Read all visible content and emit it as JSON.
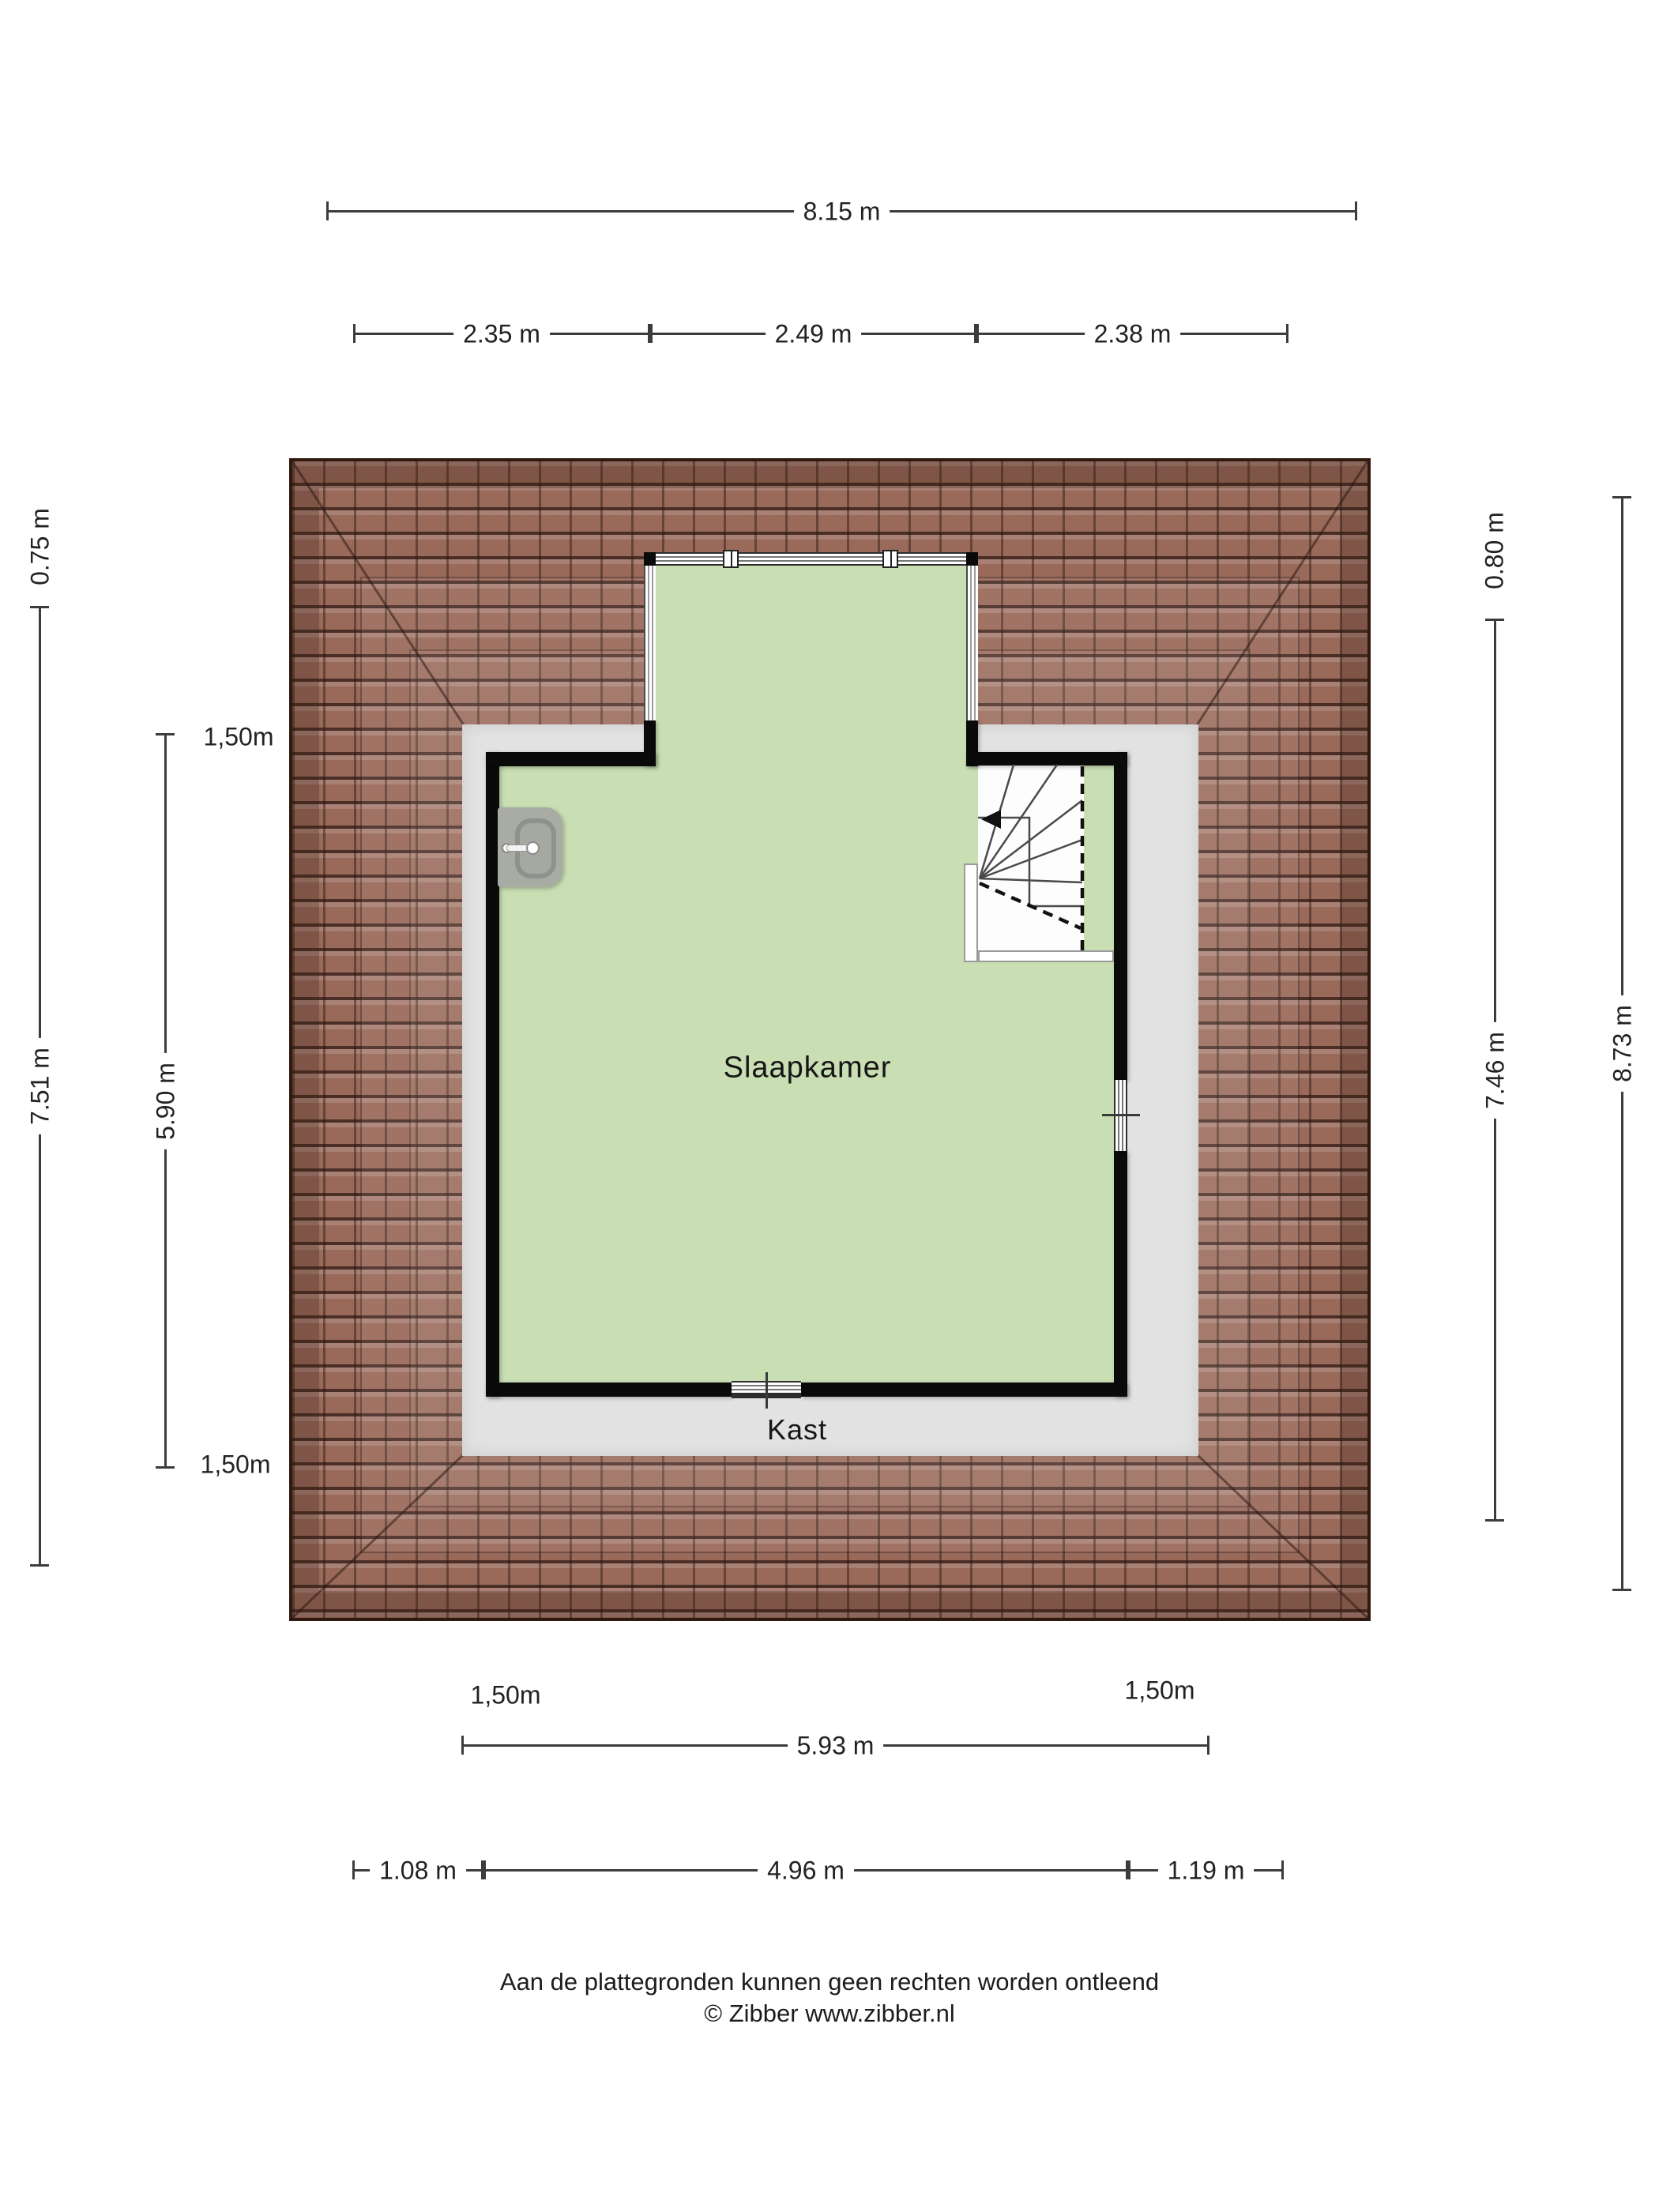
{
  "title": "Attic floor plan",
  "rooms": {
    "bedroom": "Slaapkamer",
    "closet": "Kast"
  },
  "dimensions": {
    "top": {
      "total": "8.15 m",
      "segments": [
        "2.35 m",
        "2.49 m",
        "2.38 m"
      ]
    },
    "left": {
      "overhang": "0.75 m",
      "total": "7.51 m",
      "inner": "5.90 m",
      "knee_top": "1,50m",
      "knee_bottom": "1,50m"
    },
    "right": {
      "overhang": "0.80 m",
      "inner": "7.46 m",
      "total": "8.73 m"
    },
    "bottom": {
      "knee_left": "1,50m",
      "knee_right": "1,50m",
      "inner": "5.93 m",
      "segments": [
        "1.08 m",
        "4.96 m",
        "1.19 m"
      ]
    }
  },
  "footer": {
    "disclaimer": "Aan de plattegronden kunnen geen rechten worden ontleend",
    "credit": "© Zibber www.zibber.nl"
  },
  "theme": {
    "page_bg": "#ffffff",
    "ink": "#1f1f1f",
    "dim_line": "#3c3c3c",
    "room_green": "#c9dfb3",
    "floor_gray": "#e2e2e2",
    "wall_black": "#0a0a0a",
    "tile_base": "#99695a",
    "tile_dark": "#30190f",
    "fixture_gray": "#a9aba5"
  }
}
